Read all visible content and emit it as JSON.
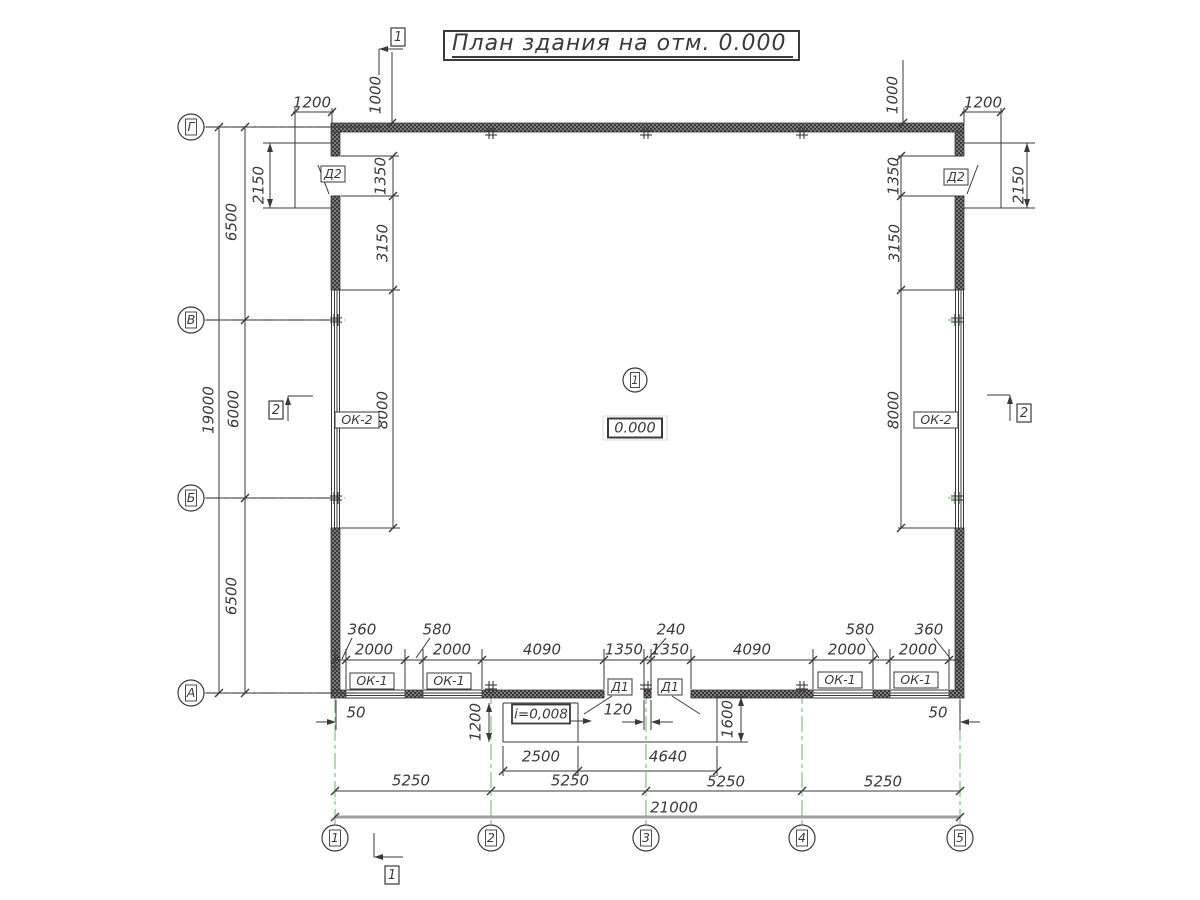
{
  "title": "План здания на отм. 0.000",
  "colors": {
    "line": "#3a3a3a",
    "axis_green": "#7cc47c",
    "wall_base": "#3a3a3a",
    "wall_dot": "#7a7a7a",
    "dim_gray": "#9e9e9e",
    "text": "#3a3a3a"
  },
  "grid": {
    "rows": [
      {
        "label": "Г",
        "y": 127
      },
      {
        "label": "В",
        "y": 320
      },
      {
        "label": "Б",
        "y": 498
      },
      {
        "label": "А",
        "y": 693
      }
    ],
    "cols": [
      {
        "label": "1",
        "x": 335
      },
      {
        "label": "2",
        "x": 491
      },
      {
        "label": "3",
        "x": 646
      },
      {
        "label": "4",
        "x": 802
      },
      {
        "label": "5",
        "x": 960
      }
    ],
    "row_circle_x": 191,
    "col_circle_y": 838
  },
  "room": {
    "number": "1",
    "x": 635,
    "y": 380
  },
  "elevation": {
    "t": "0.000",
    "x": 635,
    "y": 428
  },
  "slope": {
    "t": "i=0,008",
    "x": 541,
    "y": 714
  },
  "dim_labels": [
    {
      "t": "1200",
      "x": 312,
      "y": 103
    },
    {
      "t": "1000",
      "x": 376,
      "y": 95,
      "r": -90
    },
    {
      "t": "1000",
      "x": 893,
      "y": 95,
      "r": -90
    },
    {
      "t": "1200",
      "x": 983,
      "y": 103
    },
    {
      "t": "2150",
      "x": 259,
      "y": 185,
      "r": -90
    },
    {
      "t": "2150",
      "x": 1019,
      "y": 185,
      "r": -90
    },
    {
      "t": "1350",
      "x": 381,
      "y": 176,
      "r": -90
    },
    {
      "t": "3150",
      "x": 383,
      "y": 243,
      "r": -90
    },
    {
      "t": "8000",
      "x": 383,
      "y": 410,
      "r": -90
    },
    {
      "t": "1350",
      "x": 894,
      "y": 176,
      "r": -90
    },
    {
      "t": "3150",
      "x": 895,
      "y": 243,
      "r": -90
    },
    {
      "t": "8000",
      "x": 894,
      "y": 410,
      "r": -90
    },
    {
      "t": "6500",
      "x": 232,
      "y": 222,
      "r": -90
    },
    {
      "t": "6000",
      "x": 234,
      "y": 409,
      "r": -90
    },
    {
      "t": "6500",
      "x": 232,
      "y": 596,
      "r": -90
    },
    {
      "t": "19000",
      "x": 209,
      "y": 410,
      "r": -90
    },
    {
      "t": "360",
      "x": 362,
      "y": 630
    },
    {
      "t": "2000",
      "x": 374,
      "y": 650
    },
    {
      "t": "580",
      "x": 437,
      "y": 630
    },
    {
      "t": "2000",
      "x": 452,
      "y": 650
    },
    {
      "t": "4090",
      "x": 542,
      "y": 650
    },
    {
      "t": "1350",
      "x": 624,
      "y": 650
    },
    {
      "t": "240",
      "x": 671,
      "y": 630
    },
    {
      "t": "1350",
      "x": 670,
      "y": 650
    },
    {
      "t": "4090",
      "x": 752,
      "y": 650
    },
    {
      "t": "2000",
      "x": 847,
      "y": 650
    },
    {
      "t": "580",
      "x": 860,
      "y": 630
    },
    {
      "t": "2000",
      "x": 918,
      "y": 650
    },
    {
      "t": "360",
      "x": 929,
      "y": 630
    },
    {
      "t": "50",
      "x": 356,
      "y": 713
    },
    {
      "t": "50",
      "x": 938,
      "y": 713
    },
    {
      "t": "1200",
      "x": 476,
      "y": 722,
      "r": -90
    },
    {
      "t": "120",
      "x": 618,
      "y": 710
    },
    {
      "t": "1600",
      "x": 728,
      "y": 719,
      "r": -90
    },
    {
      "t": "2500",
      "x": 541,
      "y": 757
    },
    {
      "t": "4640",
      "x": 668,
      "y": 757
    },
    {
      "t": "5250",
      "x": 411,
      "y": 781
    },
    {
      "t": "5250",
      "x": 570,
      "y": 781
    },
    {
      "t": "5250",
      "x": 726,
      "y": 782
    },
    {
      "t": "5250",
      "x": 883,
      "y": 782
    },
    {
      "t": "21000",
      "x": 674,
      "y": 808
    }
  ],
  "tags": [
    {
      "t": "ОК-1",
      "x": 372,
      "y": 681
    },
    {
      "t": "ОК-1",
      "x": 449,
      "y": 681
    },
    {
      "t": "ОК-1",
      "x": 840,
      "y": 680
    },
    {
      "t": "ОК-1",
      "x": 916,
      "y": 680
    },
    {
      "t": "ОК-2",
      "x": 357,
      "y": 420
    },
    {
      "t": "ОК-2",
      "x": 936,
      "y": 420
    },
    {
      "t": "Д1",
      "x": 620,
      "y": 687
    },
    {
      "t": "Д1",
      "x": 670,
      "y": 687
    },
    {
      "t": "Д2",
      "x": 333,
      "y": 174
    },
    {
      "t": "Д2",
      "x": 956,
      "y": 177
    }
  ],
  "section_markers": [
    {
      "label": "1",
      "box": [
        398,
        37
      ],
      "tail": [
        379,
        49,
        379,
        75
      ],
      "shaft": [
        403,
        49,
        379,
        49
      ],
      "tip": [
        379,
        49
      ],
      "dir": "left"
    },
    {
      "label": "1",
      "box": [
        392,
        875
      ],
      "tail": [
        374,
        833,
        374,
        857
      ],
      "shaft": [
        403,
        857,
        374,
        857
      ],
      "tip": [
        374,
        857
      ],
      "dir": "left"
    },
    {
      "label": "2",
      "box": [
        276,
        410
      ],
      "tail": [
        288,
        396,
        288,
        421
      ],
      "shaft": [
        313,
        396,
        288,
        396
      ],
      "tip": [
        288,
        396
      ],
      "dir": "up"
    },
    {
      "label": "2",
      "box": [
        1024,
        413
      ],
      "tail": [
        1010,
        395,
        1010,
        421
      ],
      "shaft": [
        987,
        395,
        1010,
        395
      ],
      "tip": [
        1010,
        395
      ],
      "dir": "up"
    }
  ],
  "crosses": [
    [
      491,
      133
    ],
    [
      646,
      133
    ],
    [
      802,
      133
    ],
    [
      491,
      687
    ],
    [
      646,
      687
    ],
    [
      802,
      687
    ],
    [
      336,
      320
    ],
    [
      336,
      498
    ],
    [
      957,
      320
    ],
    [
      957,
      498
    ]
  ]
}
